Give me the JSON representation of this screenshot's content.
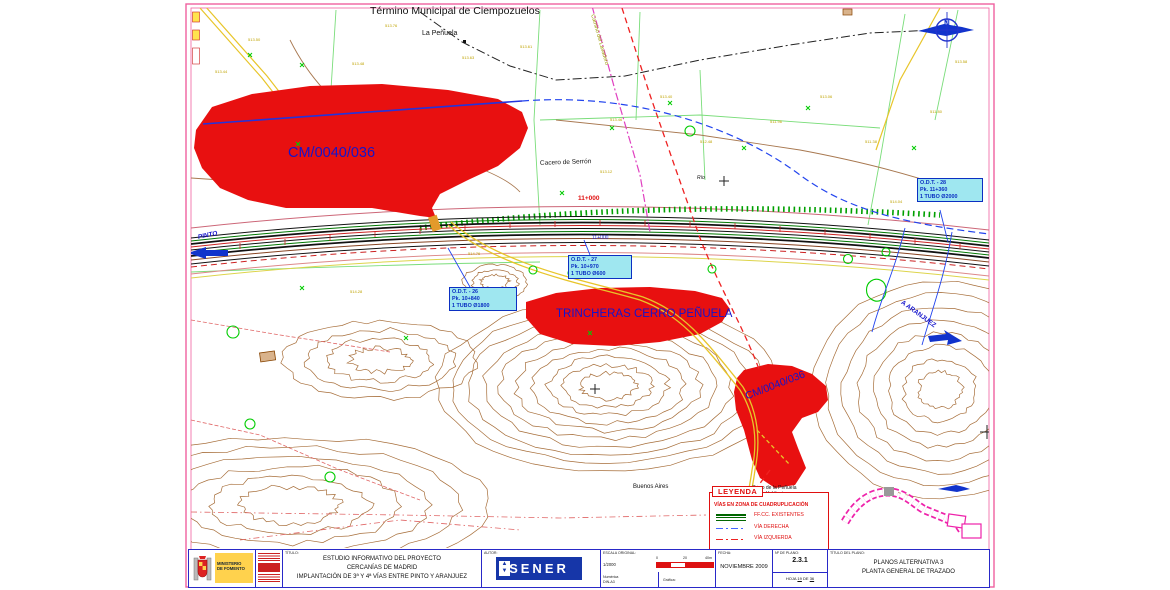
{
  "map": {
    "municipality": "Término Municipal de Ciempozuelos",
    "la_penuela": "La Peñuela",
    "camino": "Camino del Lavadero",
    "cacero": "Cacero de Serrón",
    "rio": "Río",
    "km_red": "11+000",
    "km_blue": "11+000",
    "area1_label": "CM/0040/036",
    "area2_label": "TRINCHERAS CERRO PEÑUELA",
    "area3_label": "CM/0040/036",
    "buenos_aires": "Buenos Aires",
    "cerro_note_line1": "Cerro de la Peñuela",
    "cerro_note_line2": "y Valdincio",
    "pinto": "PINTO",
    "aranjuez": "A ARANJUEZ",
    "north_letter": "N",
    "odt_boxes": [
      {
        "line1": "O.D.T. - 26",
        "line2": "Pk. 10+840",
        "line3": "1 TUBO Ø1800"
      },
      {
        "line1": "O.D.T. - 27",
        "line2": "Pk. 10+970",
        "line3": "1 TUBO Ø600"
      },
      {
        "line1": "O.D.T. - 28",
        "line2": "Pk. 11+360",
        "line3": "1 TUBO Ø2000"
      }
    ],
    "elevations": [
      "513.50",
      "513.76",
      "513.63",
      "513.61",
      "513.48",
      "513.44",
      "513.46",
      "513.40",
      "512.48",
      "511.96",
      "513.06",
      "511.38",
      "511.80",
      "513.58",
      "514.04",
      "513.12",
      "514.76",
      "514.28"
    ]
  },
  "legend": {
    "title": "LEYENDA",
    "header": "VÍAS EN ZONA DE CUADRUPLICACIÓN",
    "items": [
      {
        "label": "FF.CC. EXISTENTES"
      },
      {
        "label": "VÍA DERECHA"
      },
      {
        "label": "VÍA IZQUIERDA"
      }
    ]
  },
  "titleblock": {
    "ministry_line1": "MINISTERIO",
    "ministry_line2": "DE FOMENTO",
    "titulo_label": "TÍTULO:",
    "project_line1": "ESTUDIO INFORMATIVO DEL PROYECTO",
    "project_line2": "CERCANÍAS DE MADRID",
    "project_line3": "IMPLANTACIÓN DE 3ª Y 4ª VÍAS ENTRE PINTO Y ARANJUEZ",
    "autor_label": "AUTOR:",
    "sener": "SENER",
    "escala_label": "ESCALA ORIGINAL:",
    "escala_value": "1/2000",
    "escala_numerica": "Numérica",
    "escala_din": "DIN-A3",
    "grafica_label": "Gráfica:",
    "scalebar": {
      "start": "0",
      "mid": "20",
      "end": "40m"
    },
    "fecha_label": "FECHA:",
    "fecha_value": "NOVIEMBRE 2009",
    "plano_num_label": "Nº DE PLANO:",
    "plano_num_value": "2.3.1",
    "hoja_label": "HOJA",
    "hoja_num": "19",
    "hoja_de": "DE",
    "hoja_total": "36",
    "titulo_plano_label": "TÍTULO DEL PLANO:",
    "plano_line1": "PLANOS ALTERNATIVA 3",
    "plano_line2": "PLANTA GENERAL DE TRAZADO"
  }
}
